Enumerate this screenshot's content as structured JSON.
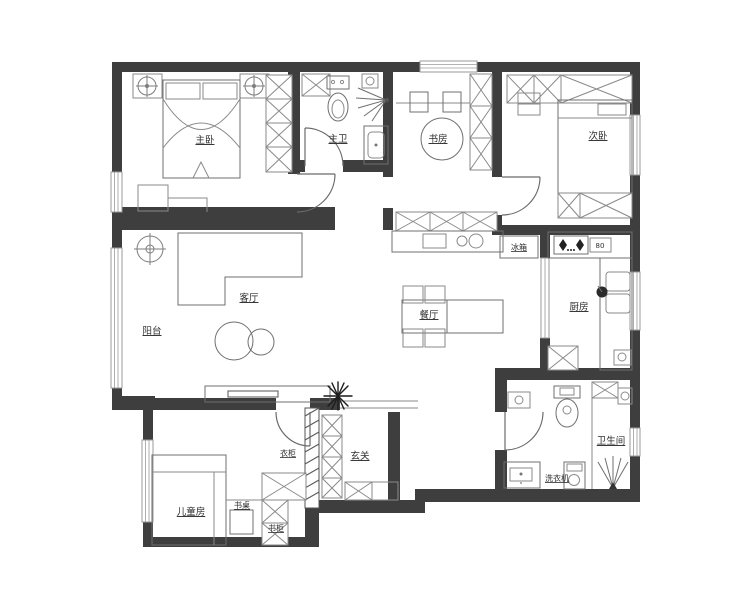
{
  "floorplan": {
    "type": "apartment-floor-plan",
    "background": "#ffffff",
    "wall_color": "#3e3e3e",
    "furniture_line_color": "#8a8a8a",
    "label_color": "#2e2e2e",
    "rooms": [
      {
        "id": "master-bedroom",
        "label": "主卧"
      },
      {
        "id": "master-bathroom",
        "label": "主卫"
      },
      {
        "id": "study",
        "label": "书房"
      },
      {
        "id": "second-bedroom",
        "label": "次卧"
      },
      {
        "id": "living-room",
        "label": "客厅"
      },
      {
        "id": "balcony",
        "label": "阳台"
      },
      {
        "id": "dining-room",
        "label": "餐厅"
      },
      {
        "id": "kitchen",
        "label": "厨房"
      },
      {
        "id": "entry-hall",
        "label": "玄关"
      },
      {
        "id": "children-room",
        "label": "儿童房"
      },
      {
        "id": "bathroom",
        "label": "卫生间"
      }
    ],
    "fixtures": [
      {
        "id": "fridge",
        "label": "冰箱"
      },
      {
        "id": "stove-dimension",
        "label": "80"
      },
      {
        "id": "wardrobe",
        "label": "衣柜"
      },
      {
        "id": "desk",
        "label": "书桌"
      },
      {
        "id": "bookcase",
        "label": "书柜"
      },
      {
        "id": "washing-machine",
        "label": "洗衣机"
      }
    ]
  }
}
